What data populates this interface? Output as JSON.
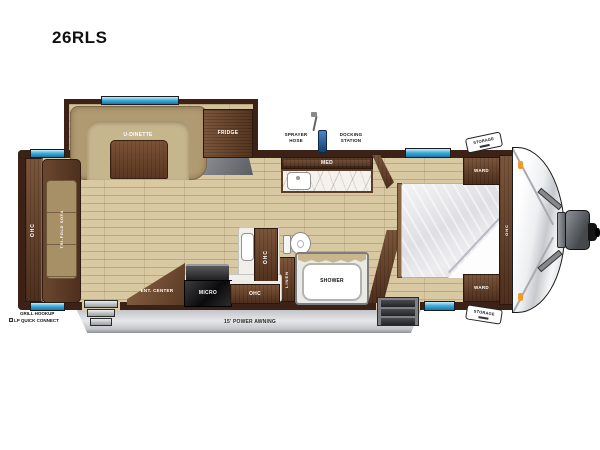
{
  "title": "26RLS",
  "palette": {
    "wall": "#3c2117",
    "wood_dark": "#4e2f1d",
    "wood_light": "#7b553a",
    "floor": "#d8c9a2",
    "dinette_tan": "#b19b73",
    "window_blue": "#45aeda",
    "awning_gray": "#c9cbcf",
    "marker_orange": "#f2992e",
    "counter_white": "#f0efec"
  },
  "labels": {
    "slideout": {
      "dinette": "U-DINETTE",
      "fridge": "FRIDGE"
    },
    "rear": {
      "ohc": "OHC",
      "sofa": "TRI-FOLD SOFA"
    },
    "bath": {
      "med": "MED",
      "linen": "LINEN",
      "shower": "SHOWER"
    },
    "kitchen": {
      "ent_center": "ENT. CENTER",
      "micro": "MICRO",
      "ohc_upper": "OHC",
      "ohc_lower": "OHC"
    },
    "bedroom": {
      "ward_top": "WARD",
      "ward_bottom": "WARD",
      "ohc": "OHC"
    },
    "exterior": {
      "sprayer_line1": "SPRAYER",
      "sprayer_line2": "HOSE",
      "docking_line1": "DOCKING",
      "docking_line2": "STATION",
      "storage_top": "STORAGE",
      "storage_bottom": "STORAGE",
      "grill_line1": "GRILL HOOKUP",
      "grill_line2": "LP QUICK CONNECT",
      "awning": "15' POWER AWNING"
    }
  }
}
